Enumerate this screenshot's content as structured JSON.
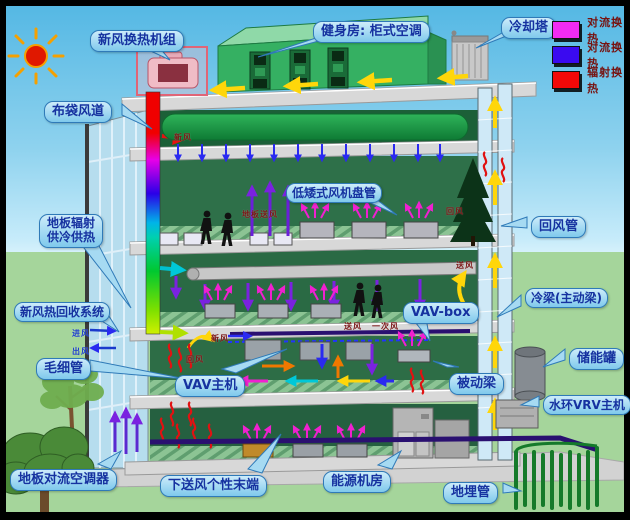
{
  "legend": {
    "items": [
      {
        "label": "对流换热",
        "color": "#f22bf2"
      },
      {
        "label": "对流换热",
        "color": "#3a0af0"
      },
      {
        "label": "辐射换热",
        "color": "#f20808"
      }
    ]
  },
  "callouts": {
    "fresh_air_unit": "新风换热机组",
    "bag_duct": "布袋风道",
    "gym_ac": "健身房: 柜式空调",
    "cooling_tower": "冷却塔",
    "floor_radiant_line1": "地板辐射",
    "floor_radiant_line2": "供冷供热",
    "heat_recovery": "新风热回收系统",
    "capillary": "毛细管",
    "floor_convector": "地板对流空调器",
    "low_fan_coil": "低矮式风机盘管",
    "vav_box": "VAV-box",
    "vav_host": "VAV主机",
    "underfloor_terminal": "下送风个性末端",
    "energy_room": "能源机房",
    "return_air_duct": "回风管",
    "chilled_beam": "冷梁(主动梁)",
    "storage_tank": "储能罐",
    "passive_beam": "被动梁",
    "water_loop_vrv": "水环VRV主机",
    "ground_pipe": "地埋管"
  },
  "flow_tags": {
    "fresh_air": "新风",
    "return_air": "回风",
    "supply_air": "送风",
    "primary_air": "一次风",
    "inlet_air": "进风",
    "outlet_air": "出风",
    "floor_supply": "地板送风"
  }
}
